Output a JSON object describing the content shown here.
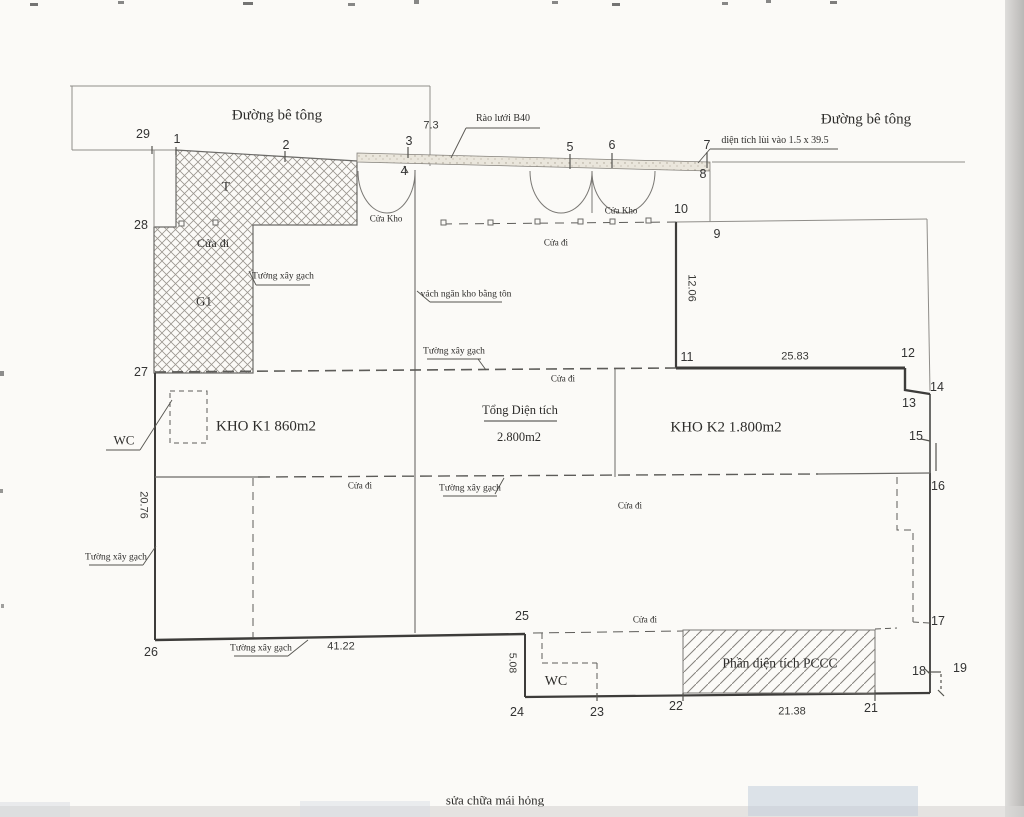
{
  "drawing": {
    "footer_note": "sửa chữa mái hỏng",
    "total_area": "2.800m2",
    "kho_k1_area": "860m2",
    "kho_k2_area": "1.800m2",
    "setback": "1.5 x 39.5",
    "fence_type": "Rào lưới B40"
  },
  "colors": {
    "line_dark": "#3d3c3a",
    "line_mid": "#6b6a67",
    "line_thin": "#8f8d89",
    "hatch": "#9a968f",
    "band_fill": "#eae6dc",
    "text": "#2e2d2b",
    "watermark": "#c3cedd"
  },
  "labels": [
    {
      "id": "road-label-left",
      "text": "Đường bê tông",
      "x": 277,
      "y": 116,
      "fs": 15
    },
    {
      "id": "road-label-right",
      "text": "Đường bê tông",
      "x": 866,
      "y": 120,
      "fs": 15
    },
    {
      "id": "fence-note",
      "text": "Rào lưới B40",
      "x": 503,
      "y": 119,
      "fs": 10
    },
    {
      "id": "setback-note",
      "text": "diện tích lùi vào 1.5 x 39.5",
      "x": 775,
      "y": 141,
      "fs": 10
    },
    {
      "id": "dim-road-width",
      "text": "7.3",
      "x": 431,
      "y": 126,
      "fs": 11,
      "num": true
    },
    {
      "id": "area-T-label",
      "text": "T",
      "x": 226,
      "y": 186,
      "fs": 13
    },
    {
      "id": "door-label-hatch",
      "text": "Cửa đi",
      "x": 213,
      "y": 243,
      "fs": 12
    },
    {
      "id": "area-G1-label",
      "text": "G1",
      "x": 204,
      "y": 301,
      "fs": 13
    },
    {
      "id": "door-kho-label-1",
      "text": "Cửa Kho",
      "x": 386,
      "y": 219,
      "fs": 9
    },
    {
      "id": "door-kho-label-2",
      "text": "Cửa Kho",
      "x": 621,
      "y": 211,
      "fs": 9
    },
    {
      "id": "door-label-1",
      "text": "Cửa đi",
      "x": 556,
      "y": 243,
      "fs": 9
    },
    {
      "id": "wall-note-1",
      "text": "Tường xây gạch",
      "x": 283,
      "y": 277,
      "fs": 9.5
    },
    {
      "id": "partition-note",
      "text": "vách ngăn kho bằng tôn",
      "x": 466,
      "y": 295,
      "fs": 9.5
    },
    {
      "id": "wall-note-2",
      "text": "Tường xây gạch",
      "x": 454,
      "y": 352,
      "fs": 9.5
    },
    {
      "id": "dim-12-06",
      "text": "12.06",
      "x": 691,
      "y": 288,
      "fs": 11,
      "rot": 90,
      "num": true
    },
    {
      "id": "dim-25-83",
      "text": "25.83",
      "x": 795,
      "y": 357,
      "fs": 11,
      "num": true
    },
    {
      "id": "door-label-2",
      "text": "Cửa đi",
      "x": 563,
      "y": 379,
      "fs": 9
    },
    {
      "id": "room-kho-k1",
      "text": "KHO K1 860m2",
      "x": 266,
      "y": 427,
      "fs": 15
    },
    {
      "id": "total-area-title",
      "text": "Tổng Diện tích",
      "x": 520,
      "y": 410,
      "fs": 12.5
    },
    {
      "id": "total-area-value",
      "text": "2.800m2",
      "x": 519,
      "y": 437,
      "fs": 12.5
    },
    {
      "id": "room-kho-k2",
      "text": "KHO K2 1.800m2",
      "x": 726,
      "y": 428,
      "fs": 15
    },
    {
      "id": "wc-label-top",
      "text": "WC",
      "x": 124,
      "y": 440,
      "fs": 13
    },
    {
      "id": "door-label-3",
      "text": "Cửa đi",
      "x": 360,
      "y": 486,
      "fs": 9
    },
    {
      "id": "wall-note-3",
      "text": "Tường xây gạch",
      "x": 470,
      "y": 489,
      "fs": 9.5
    },
    {
      "id": "door-label-4",
      "text": "Cửa đi",
      "x": 630,
      "y": 506,
      "fs": 9
    },
    {
      "id": "dim-20-76",
      "text": "20.76",
      "x": 143,
      "y": 505,
      "fs": 11,
      "rot": 90,
      "num": true
    },
    {
      "id": "wall-note-4",
      "text": "Tường xây gạch",
      "x": 116,
      "y": 558,
      "fs": 9.5
    },
    {
      "id": "wall-note-5",
      "text": "Tường xây gạch",
      "x": 261,
      "y": 649,
      "fs": 9.5
    },
    {
      "id": "dim-41-22",
      "text": "41.22",
      "x": 341,
      "y": 647,
      "fs": 11,
      "num": true
    },
    {
      "id": "door-label-5",
      "text": "Cửa đi",
      "x": 645,
      "y": 620,
      "fs": 9
    },
    {
      "id": "dim-5-08",
      "text": "5.08",
      "x": 512,
      "y": 663,
      "fs": 10.5,
      "rot": 90,
      "num": true
    },
    {
      "id": "wc-label-bottom",
      "text": "WC",
      "x": 556,
      "y": 682,
      "fs": 14
    },
    {
      "id": "pccc-area-label",
      "text": "Phần diện tích PCCC",
      "x": 780,
      "y": 663,
      "fs": 13.5
    },
    {
      "id": "dim-21-38",
      "text": "21.38",
      "x": 792,
      "y": 712,
      "fs": 11,
      "num": true
    },
    {
      "id": "footer-note",
      "text": "sửa chữa mái hỏng",
      "x": 495,
      "y": 800,
      "fs": 13
    }
  ],
  "points": [
    {
      "n": "29",
      "x": 143,
      "y": 134
    },
    {
      "n": "1",
      "x": 177,
      "y": 139
    },
    {
      "n": "2",
      "x": 286,
      "y": 145
    },
    {
      "n": "3",
      "x": 409,
      "y": 141
    },
    {
      "n": "4",
      "x": 404,
      "y": 171
    },
    {
      "n": "5",
      "x": 570,
      "y": 147
    },
    {
      "n": "6",
      "x": 612,
      "y": 145
    },
    {
      "n": "7",
      "x": 707,
      "y": 145
    },
    {
      "n": "8",
      "x": 703,
      "y": 174
    },
    {
      "n": "10",
      "x": 681,
      "y": 209
    },
    {
      "n": "9",
      "x": 717,
      "y": 234
    },
    {
      "n": "11",
      "x": 687,
      "y": 357
    },
    {
      "n": "12",
      "x": 908,
      "y": 353
    },
    {
      "n": "14",
      "x": 937,
      "y": 387
    },
    {
      "n": "13",
      "x": 909,
      "y": 403
    },
    {
      "n": "15",
      "x": 916,
      "y": 436
    },
    {
      "n": "16",
      "x": 938,
      "y": 486
    },
    {
      "n": "17",
      "x": 938,
      "y": 621
    },
    {
      "n": "18",
      "x": 919,
      "y": 671
    },
    {
      "n": "19",
      "x": 960,
      "y": 668
    },
    {
      "n": "21",
      "x": 871,
      "y": 708
    },
    {
      "n": "22",
      "x": 676,
      "y": 706
    },
    {
      "n": "23",
      "x": 597,
      "y": 712
    },
    {
      "n": "24",
      "x": 517,
      "y": 712
    },
    {
      "n": "25",
      "x": 522,
      "y": 616
    },
    {
      "n": "26",
      "x": 151,
      "y": 652
    },
    {
      "n": "27",
      "x": 141,
      "y": 372
    },
    {
      "n": "28",
      "x": 141,
      "y": 225
    }
  ]
}
